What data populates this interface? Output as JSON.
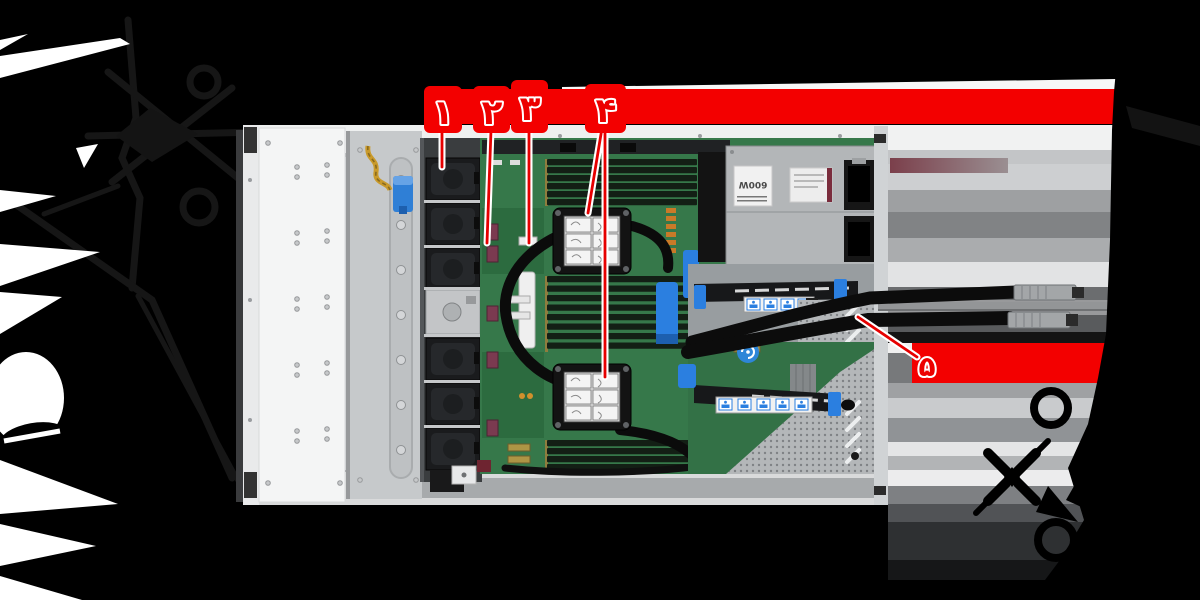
{
  "background": {
    "color": "#000000"
  },
  "banner": {
    "accent_red": "#f30000",
    "number_red": "#ec0000",
    "line_red": "#e60000",
    "halo": "#ffffff"
  },
  "callouts": {
    "items": [
      {
        "label": "۱"
      },
      {
        "label": "۲"
      },
      {
        "label": "۳"
      },
      {
        "label": "۴"
      },
      {
        "label": "۵"
      }
    ]
  },
  "server": {
    "psu_wattage_label": "600W",
    "pcb_green": "#36784a",
    "chassis_gray": "#eef0f0",
    "latch_blue": "#2f7fd6",
    "riser_blue": "#2b7fe0"
  }
}
